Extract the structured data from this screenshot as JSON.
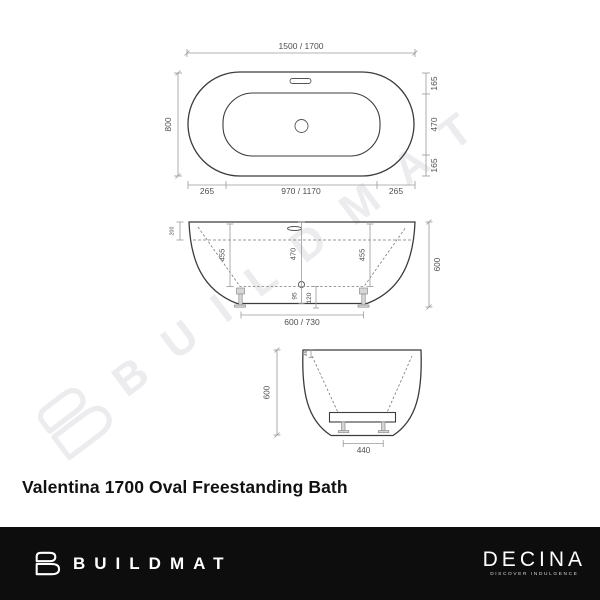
{
  "title": "Valentina 1700 Oval Freestanding Bath",
  "watermark": {
    "text": "BUILDMAT"
  },
  "drawing": {
    "top_view": {
      "length": "1500 / 1700",
      "width": "800",
      "right_rim_top": "165",
      "right_inner": "470",
      "right_rim_bottom": "165",
      "bottom_rim_left": "265",
      "bottom_inner": "970 / 1170",
      "bottom_rim_right": "265"
    },
    "side_view": {
      "rim_drop": "200",
      "depth_left": "455",
      "depth_center": "470",
      "depth_right": "455",
      "overall_height": "600",
      "base_clearance": "95",
      "floor_clearance": "120",
      "feet_spacing": "600 / 730"
    },
    "end_view": {
      "rim_thickness": "45",
      "overall_height": "600",
      "feet_spacing": "440"
    }
  },
  "footer": {
    "buildmat_label": "BUILDMAT",
    "decina_label": "DECINA",
    "decina_tagline": "DISCOVER INDULGENCE"
  }
}
